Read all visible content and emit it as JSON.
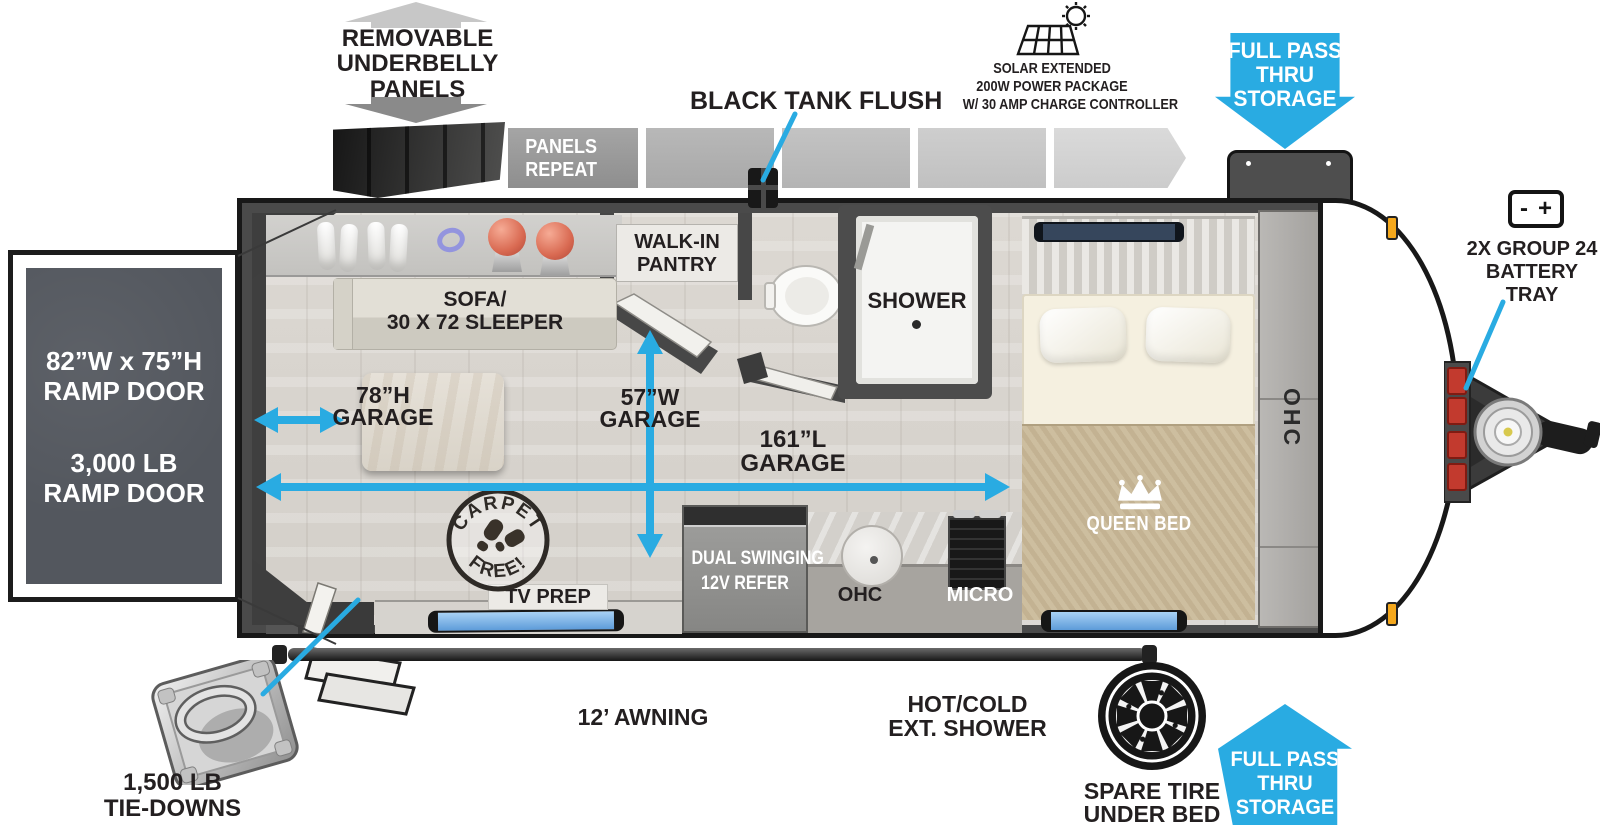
{
  "title": "Toy hauler travel trailer floorplan",
  "colors": {
    "accent_blue": "#29abe2",
    "label_black": "#231f20",
    "wall_gray": "#4a4a4a",
    "ramp_panel_gray": "#53575e",
    "badge_text_white": "#ffffff",
    "battery_red": "#c23a2e",
    "window_blue": "#6fa9e0",
    "marker_amber": "#f5a81c"
  },
  "icons": {
    "underbelly-arrow-up-icon": "up arrow",
    "underbelly-arrow-down-icon": "down arrow",
    "solar-panel-icon": "solar panel with sun",
    "battery-icon": "battery - +",
    "full-pass-thru-down-arrow-icon": "blue down arrow badge",
    "full-pass-thru-up-arrow-icon": "blue up arrow badge",
    "spare-tire-icon": "tire with spoked rim",
    "tie-down-ring-icon": "D-ring tie-down plate",
    "crown-icon": "queen crown",
    "carpet-free-stamp-icon": "circular stamp with boot prints"
  },
  "callouts": {
    "underbelly": {
      "lines": [
        "REMOVABLE",
        "UNDERBELLY",
        "PANELS"
      ]
    },
    "panels_repeat": {
      "lines": [
        "PANELS",
        "REPEAT"
      ]
    },
    "black_tank_flush": {
      "label": "BLACK TANK FLUSH"
    },
    "solar_package": {
      "lines": [
        "SOLAR EXTENDED",
        "200W POWER PACKAGE",
        "W/ 30 AMP CHARGE CONTROLLER"
      ]
    },
    "full_pass_thru_top": {
      "lines": [
        "FULL PASS",
        "THRU",
        "STORAGE"
      ]
    },
    "battery_tray": {
      "icon_minus": "-",
      "icon_plus": "+",
      "lines": [
        "2X GROUP 24",
        "BATTERY",
        "TRAY"
      ]
    },
    "ramp_door_size": {
      "lines": [
        "82”W x 75”H",
        "RAMP DOOR"
      ]
    },
    "ramp_door_rating": {
      "lines": [
        "3,000 LB",
        "RAMP DOOR"
      ]
    },
    "awning": {
      "label": "12’ AWNING"
    },
    "exterior_shower": {
      "lines": [
        "HOT/COLD",
        "EXT. SHOWER"
      ]
    },
    "spare_tire": {
      "lines": [
        "SPARE TIRE",
        "UNDER BED"
      ]
    },
    "full_pass_thru_bottom": {
      "lines": [
        "FULL PASS",
        "THRU",
        "STORAGE"
      ]
    },
    "tie_downs": {
      "lines": [
        "1,500 LB",
        "TIE-DOWNS"
      ]
    }
  },
  "interior": {
    "sofa": {
      "lines": [
        "SOFA/",
        "30 X 72 SLEEPER"
      ]
    },
    "pantry": {
      "lines": [
        "WALK-IN",
        "PANTRY"
      ]
    },
    "shower": {
      "label": "SHOWER"
    },
    "queen_bed": {
      "label": "QUEEN BED"
    },
    "ohc_front": {
      "label": "OHC"
    },
    "garage_height": {
      "lines": [
        "78”H",
        "GARAGE"
      ]
    },
    "garage_width": {
      "lines": [
        "57”W",
        "GARAGE"
      ]
    },
    "garage_length": {
      "lines": [
        "161”L",
        "GARAGE"
      ]
    },
    "carpet_free": {
      "top": "CARPET",
      "bottom": "FREE!"
    },
    "tv_prep": {
      "label": "TV PREP"
    },
    "refrigerator": {
      "lines": [
        "DUAL SWINGING",
        "12V REFER"
      ]
    },
    "ohc_kitchen": {
      "label": "OHC"
    },
    "microwave": {
      "label": "MICRO"
    }
  }
}
